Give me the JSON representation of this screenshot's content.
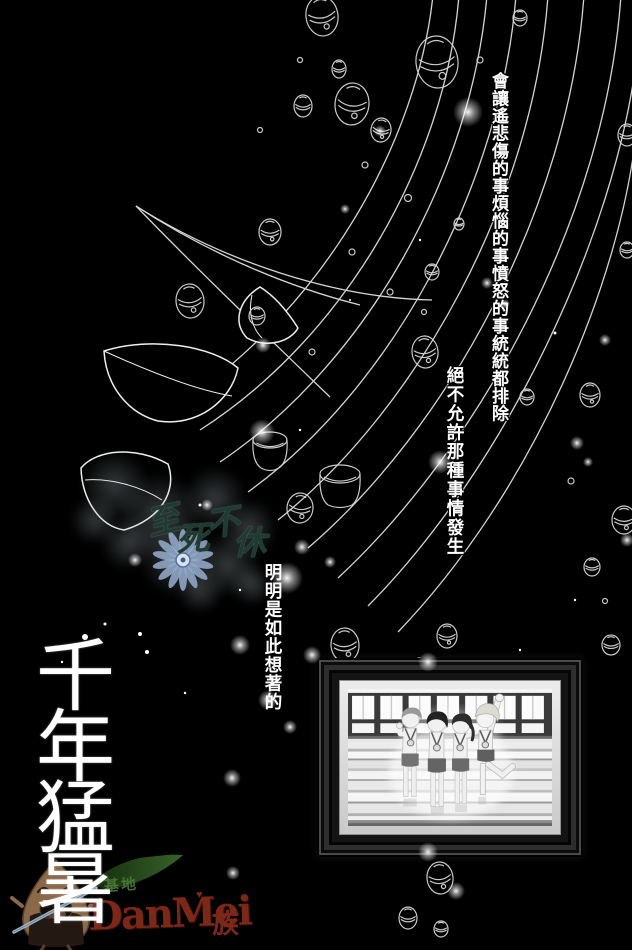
{
  "page": {
    "background": "#000000"
  },
  "dialogue": {
    "col1": "會讓遙悲傷的事煩惱的事憤怒的事統統都排除",
    "col2": "絕不允許那種事情發生",
    "col3": "明明是如此想著的",
    "text_color": "#ffffff",
    "outline_color": "#000000"
  },
  "title": {
    "text": "千年猛暑",
    "color": "#ffffff"
  },
  "watermarks": {
    "scanlation": {
      "text": "至死不休",
      "chars": [
        "至",
        "死",
        "不",
        "休"
      ],
      "ink_color": "#1d3b31",
      "flower_color": "#97aed0"
    },
    "site": {
      "name": "DanMei",
      "suffix": "族",
      "heart": "♥",
      "color": "#7b2818"
    },
    "site_green": {
      "text": "基地",
      "color": "#4f8038"
    }
  }
}
